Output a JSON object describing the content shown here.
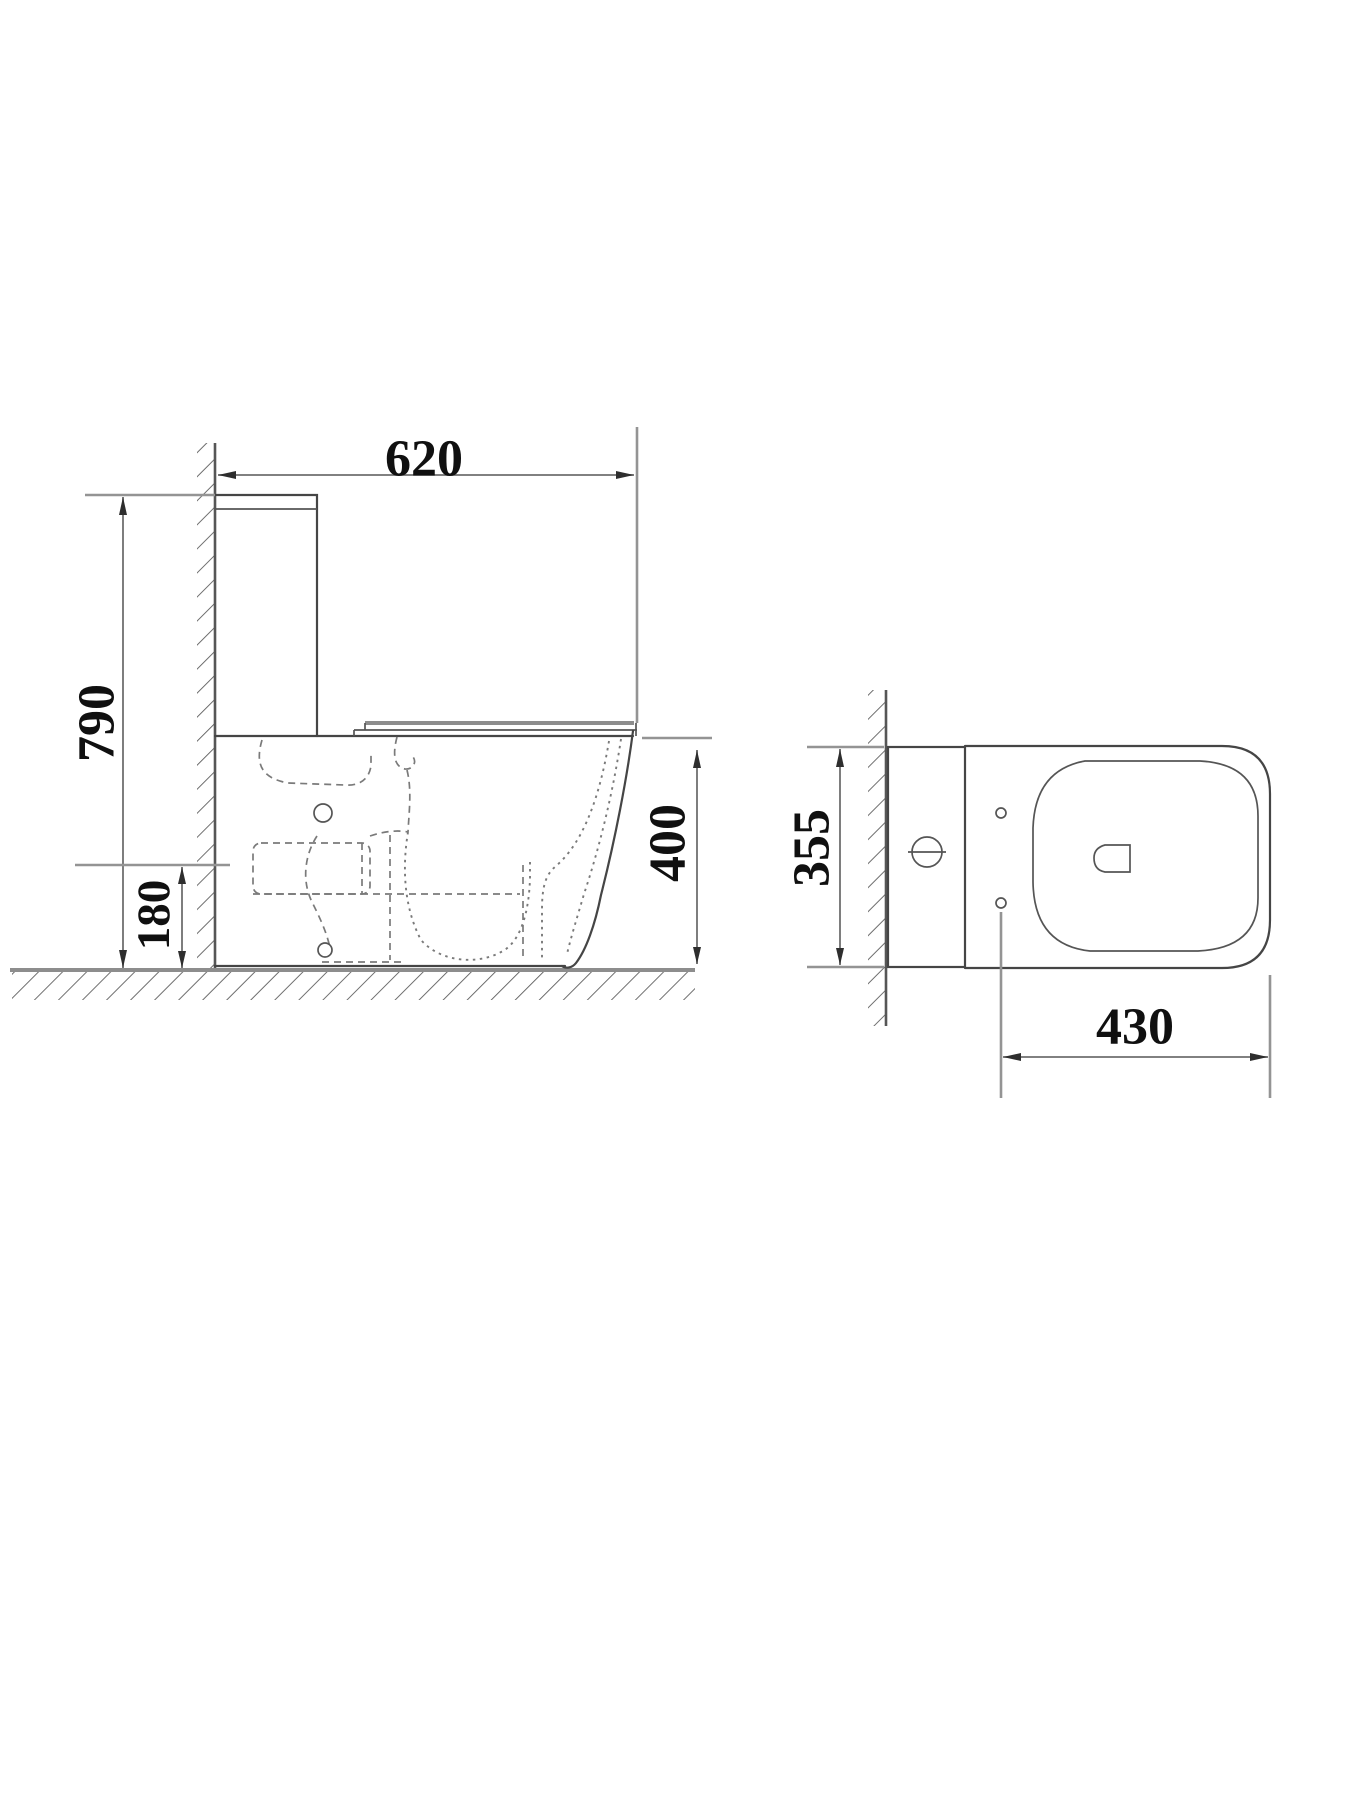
{
  "drawing": {
    "type": "toilet-technical-drawing",
    "views": [
      "side-elevation",
      "top-plan"
    ]
  },
  "dims": {
    "side": {
      "width": "620",
      "height": "790",
      "seat_height": "400",
      "inlet_height": "180"
    },
    "top": {
      "width": "355",
      "length": "430"
    }
  },
  "colors": {
    "background": "#ffffff",
    "outline_ink": "#454545",
    "dimension_line": "#6f6f6f",
    "extension_line": "#949494",
    "hatch": "#5e5e5e",
    "label_ink": "#101010"
  }
}
